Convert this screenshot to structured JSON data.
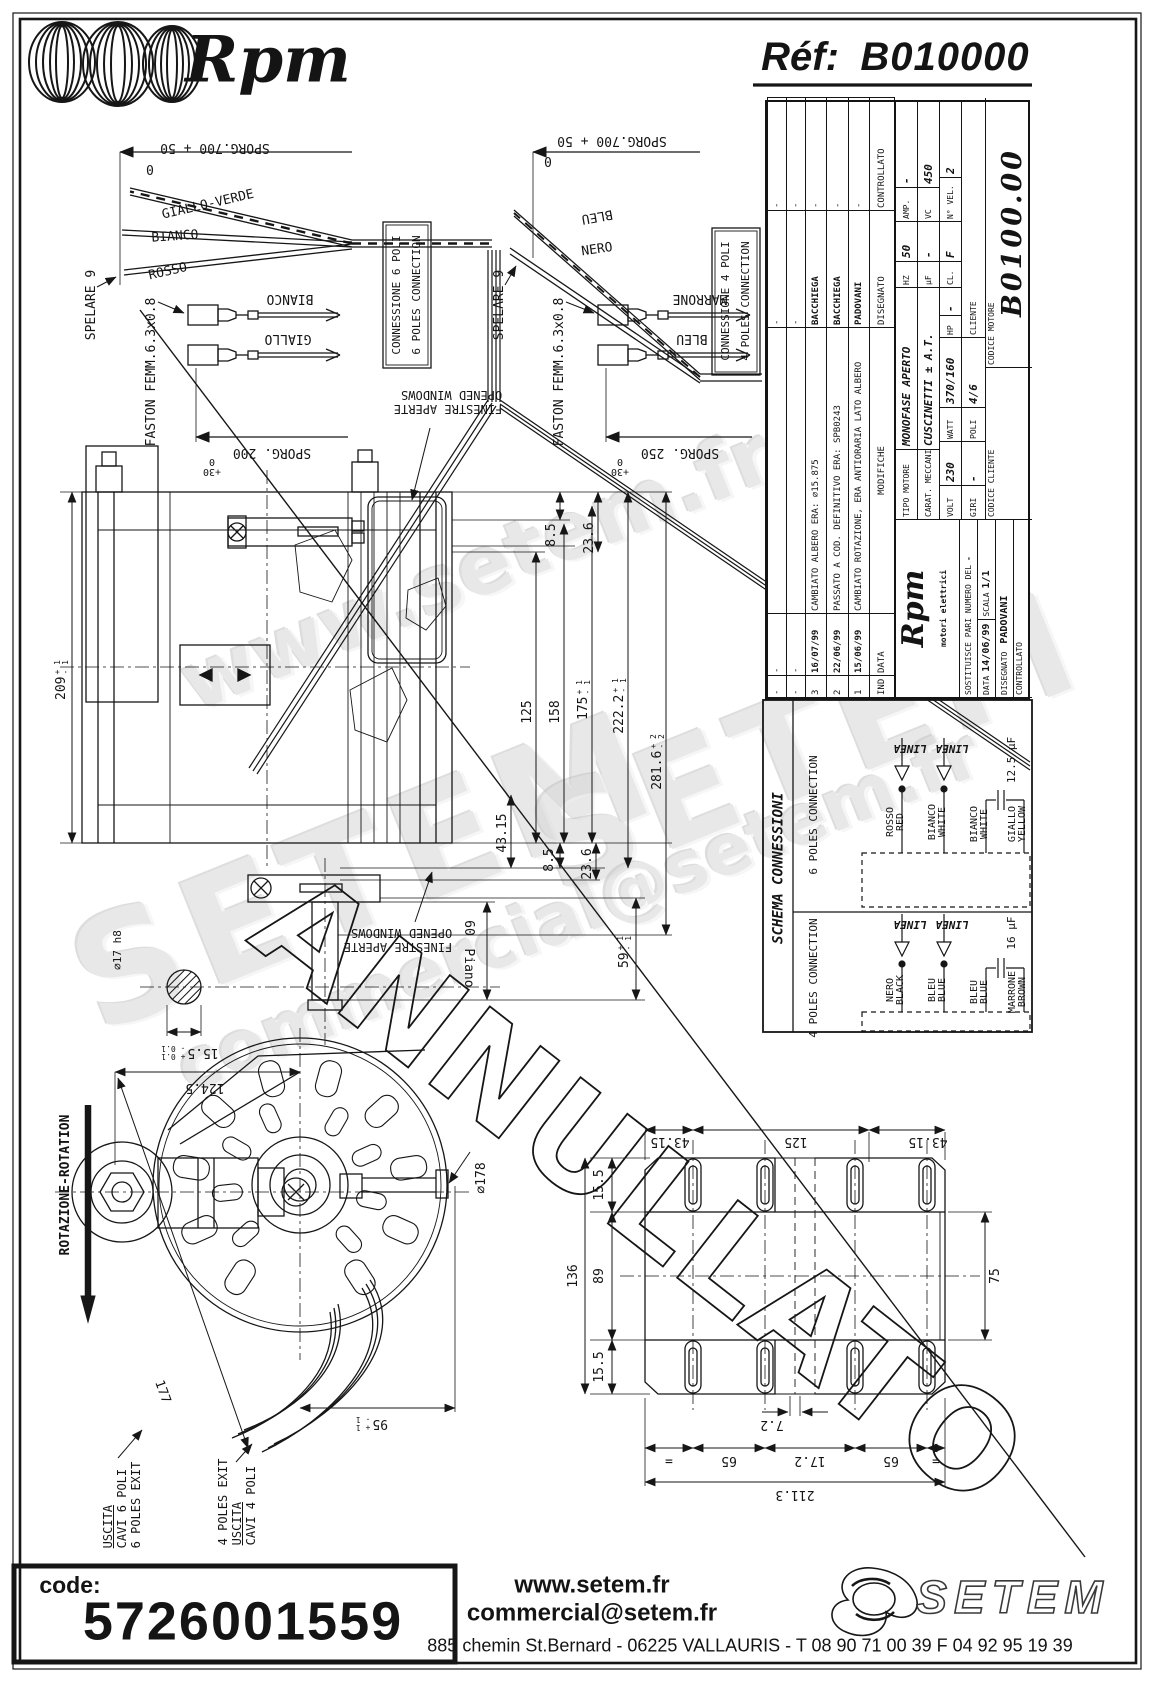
{
  "header": {
    "logo": "Rpm",
    "ref_label": "Réf:",
    "ref_value": "B010000"
  },
  "stamp": "ANNULLATO",
  "watermarks": {
    "top": "www.setem.fr",
    "mid": "SETEM",
    "mid2": "SETEM",
    "bottom": "commercial@setem.fr"
  },
  "wires6": {
    "sporg700": "SPORG.700 + 50",
    "zero": "0",
    "giallo_verde": "GIALLO-VERDE",
    "bianco": "BIANCO",
    "rosso": "ROSSO",
    "spelare": "SPELARE 9",
    "faston": "FASTON FEMM.6.3x0.8",
    "faston_bianco": "BIANCO",
    "faston_giallo": "GIALLO",
    "sporg200": "SPORG. 200",
    "tol_p": "+30",
    "tol_z": "0"
  },
  "wires4": {
    "sporg700": "SPORG.700 + 50",
    "zero": "0",
    "bleu": "BLEU",
    "nero": "NERO",
    "spelare": "SPELARE 9",
    "faston": "FASTON FEMM.6.3x0.8",
    "faston_marrone": "MARRONE",
    "faston_bleu": "BLEU",
    "sporg250": "SPORG. 250",
    "tol_p": "+30",
    "tol_z": "0"
  },
  "conn_boxes": {
    "c6_l1": "CONNESSIONE 6 POLI",
    "c6_l2": "6 POLES CONNECTION",
    "c4_l1": "CONNESSIONE 4 POLI",
    "c4_l2": "4 POLES CONNECTION"
  },
  "notes": {
    "fin1": "FINESTRE APERTE",
    "fin2": "OPENED WINDOWS",
    "rotation": "ROTAZIONE-ROTATION",
    "out6_1": "USCITA",
    "out6_2": "CAVI 6 POLI",
    "out6_3": "6 POLES EXIT",
    "out4_1": "4 POLES EXIT",
    "out4_2": "USCITA",
    "out4_3": "CAVI 4 POLI"
  },
  "side_dims": {
    "d209": {
      "v": "209",
      "p": "+ 1",
      "m": "- 1"
    },
    "d85t": "8.5",
    "d236t": "23.6",
    "d125": "125",
    "d158": "158",
    "d175": {
      "v": "175",
      "p": "+ 1",
      "m": "- 1"
    },
    "d2222": {
      "v": "222.2",
      "p": "+ 1",
      "m": "- 1"
    },
    "d2816": {
      "v": "281.6",
      "p": "+ 2",
      "m": "- 2"
    },
    "d4315": "43.15",
    "d85b": "8.5",
    "d236b": "23.6",
    "d59": {
      "v": "59",
      "p": "+ 1",
      "m": "- 1"
    },
    "d60": "60",
    "d60b": "Piano",
    "dia17": "∅17 h8",
    "d155": {
      "v": "15.5",
      "p": "+ 0.1",
      "m": "- 0.1"
    }
  },
  "front_dims": {
    "d1245": "124.5",
    "d177": "177",
    "dia178": "∅178",
    "d95": {
      "v": "95",
      "p": "+ 1",
      "m": "- 1"
    }
  },
  "base_dims": {
    "t4315a": "43.15",
    "t125": "125",
    "t4315b": "43.15",
    "l155a": "15.5",
    "l89": "89",
    "l136": "136",
    "l155b": "15.5",
    "r75": "75",
    "b72": "7.2",
    "beq1": "=",
    "b65a": "65",
    "b172": "17.2",
    "b65b": "65",
    "beq2": "=",
    "b2113": "211.3"
  },
  "schema": {
    "title": "SCHEMA CONNESSIONI",
    "p6": {
      "label": "6 POLES CONNECTION",
      "linea1": "LINEA",
      "linea2": "LINEA",
      "w1a": "ROSSO",
      "w1b": "RED",
      "w2a": "BIANCO",
      "w2b": "WHITE",
      "w3a": "BIANCO",
      "w3b": "WHITE",
      "w4a": "GIALLO",
      "w4b": "YELLOW",
      "cap": "12.5 µF"
    },
    "p4": {
      "label": "4 POLES CONNECTION",
      "linea1": "LINEA",
      "linea2": "LINEA",
      "w1a": "NERO",
      "w1b": "BLACK",
      "w2a": "BLEU",
      "w2b": "BLUE",
      "w3a": "BLEU",
      "w3b": "BLUE",
      "w4a": "MARRONE",
      "w4b": "BROWN",
      "cap": "16 µF"
    }
  },
  "titleblock": {
    "rev_rows": [
      {
        "ind": "-",
        "date": "-",
        "text": "",
        "sign": "-",
        "check": "-"
      },
      {
        "ind": "-",
        "date": "-",
        "text": "",
        "sign": "-",
        "check": "-"
      },
      {
        "ind": "3",
        "date": "16/07/99",
        "text": "CAMBIATO ALBERO ERA: ∅15.875",
        "sign": "BACCHIEGA",
        "check": "-"
      },
      {
        "ind": "2",
        "date": "22/06/99",
        "text": "PASSATO A COD. DEFINITIVO ERA: SPB0243",
        "sign": "BACCHIEGA",
        "check": "-"
      },
      {
        "ind": "1",
        "date": "15/06/99",
        "text": "CAMBIATO ROTAZIONE, ERA ANTIORARIA LATO ALBERO",
        "sign": "PADOVANI",
        "check": "-"
      }
    ],
    "rev_header": {
      "ind": "IND",
      "date": "DATA",
      "text": "MODIFICHE",
      "sign": "DISEGNATO",
      "check": "CONTROLLATO"
    },
    "tipo_label": "TIPO MOTORE",
    "tipo_value": "MONOFASE APERTO",
    "carat_label": "CARAT. MECCANICHE",
    "carat_value": "CUSCINETTI ± A.T.",
    "volt_label": "VOLT",
    "volt": "230",
    "watt_label": "WATT",
    "watt": "370/160",
    "hp_label": "HP",
    "hp": "-",
    "hz_label": "HZ",
    "hz": "50",
    "amp_label": "AMP.",
    "amp": "-",
    "uf_label": "µF",
    "uf": "-",
    "vc_label": "VC",
    "vc": "450",
    "giri_label": "GIRI",
    "giri": "-",
    "poli_label": "POLI",
    "poli": "4/6",
    "cl_label": "CL.",
    "cl": "F",
    "nvel_label": "N° VEL.",
    "nvel": "2",
    "cliente_label": "CLIENTE",
    "logo_text": "Rpm",
    "logo_sub": "motori elettrici",
    "sost_label": "SOSTITUISCE PARI NUMERO DEL",
    "sost": "-",
    "data_label": "DATA",
    "data": "14/06/99",
    "scala_label": "SCALA",
    "scala": "1/1",
    "disegnato_label": "DISEGNATO",
    "disegnato": "PADOVANI",
    "controllato_label": "CONTROLLATO",
    "codcli_label": "CODICE CLIENTE",
    "codmot_label": "CODICE MOTORE",
    "codmot": "B0100.00"
  },
  "footer": {
    "code_label": "code:",
    "code": "5726001559",
    "web": "www.setem.fr",
    "email": "commercial@setem.fr",
    "address": "885 chemin St.Bernard  -  06225 VALLAURIS  -  T 08 90 71 00 39   F 04 92 95 19 39",
    "brand": "SETEM"
  }
}
